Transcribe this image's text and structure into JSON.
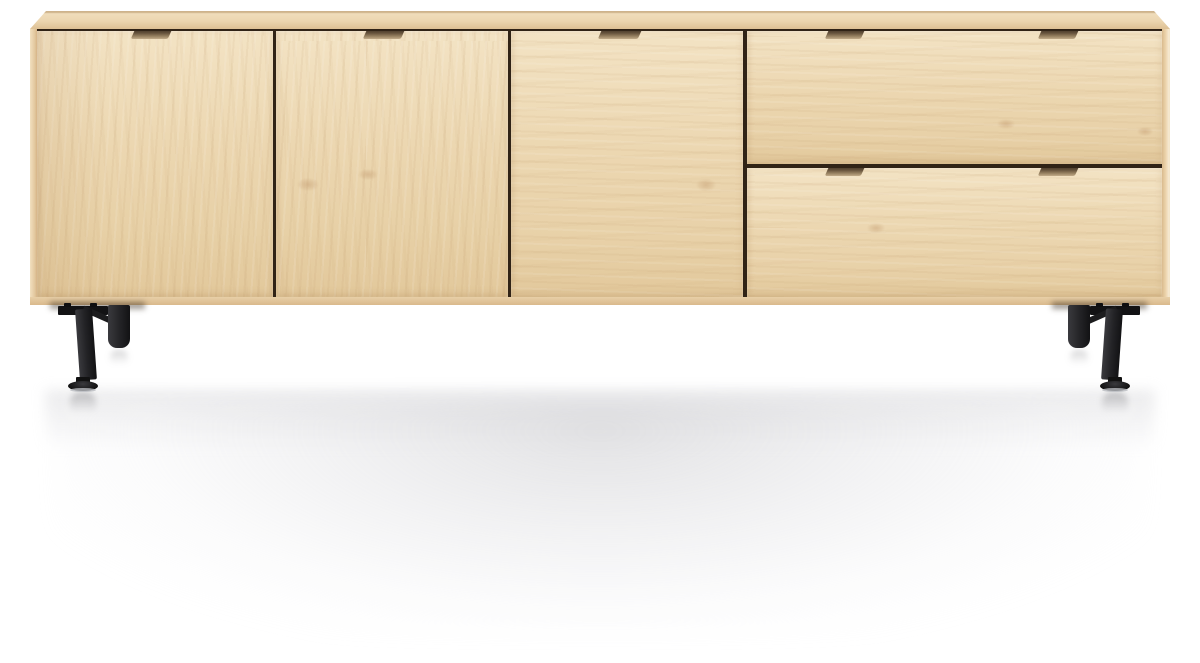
{
  "image": {
    "type": "product-photo",
    "alt": "Natural oak sideboard with three doors, two drawers, recessed finger-pull handles and black metal legs on a white studio background",
    "background_style": "white studio backdrop with soft gray floor reflection"
  },
  "furniture": {
    "category": "sideboard",
    "material": "natural oak veneer",
    "finish": "light untreated wood",
    "doors": [
      {
        "name": "left door"
      },
      {
        "name": "middle-left door"
      },
      {
        "name": "middle-right door"
      }
    ],
    "drawers": [
      {
        "name": "top drawer"
      },
      {
        "name": "bottom drawer"
      }
    ],
    "handles": {
      "style": "recessed finger-pull notch routed into panel top edge",
      "count": 7,
      "placement": "centered on each door; two per drawer"
    },
    "legs": {
      "material": "black metal",
      "assemblies": 2,
      "parts": [
        "mounting bracket",
        "vertical back leg",
        "angled front leg",
        "adjustable disc foot"
      ]
    }
  },
  "colors": {
    "background": "#ffffff",
    "wood_face_light": "#f3e3c4",
    "wood_face": "#ecd7b1",
    "wood_face_dark": "#e2c89b",
    "wood_top": "#ecd6b0",
    "wood_edge": "#e7cda4",
    "wood_edge_dark": "#d9b98c",
    "seam": "#302316",
    "handle_dark": "#33261a",
    "handle_light": "#c0a987",
    "leg_metal": "#232326",
    "leg_metal_light": "#3a3a3e",
    "leg_metal_dark": "#121214",
    "foot_rim": "#b9bcc0",
    "reflection": "#cdcdd1"
  }
}
